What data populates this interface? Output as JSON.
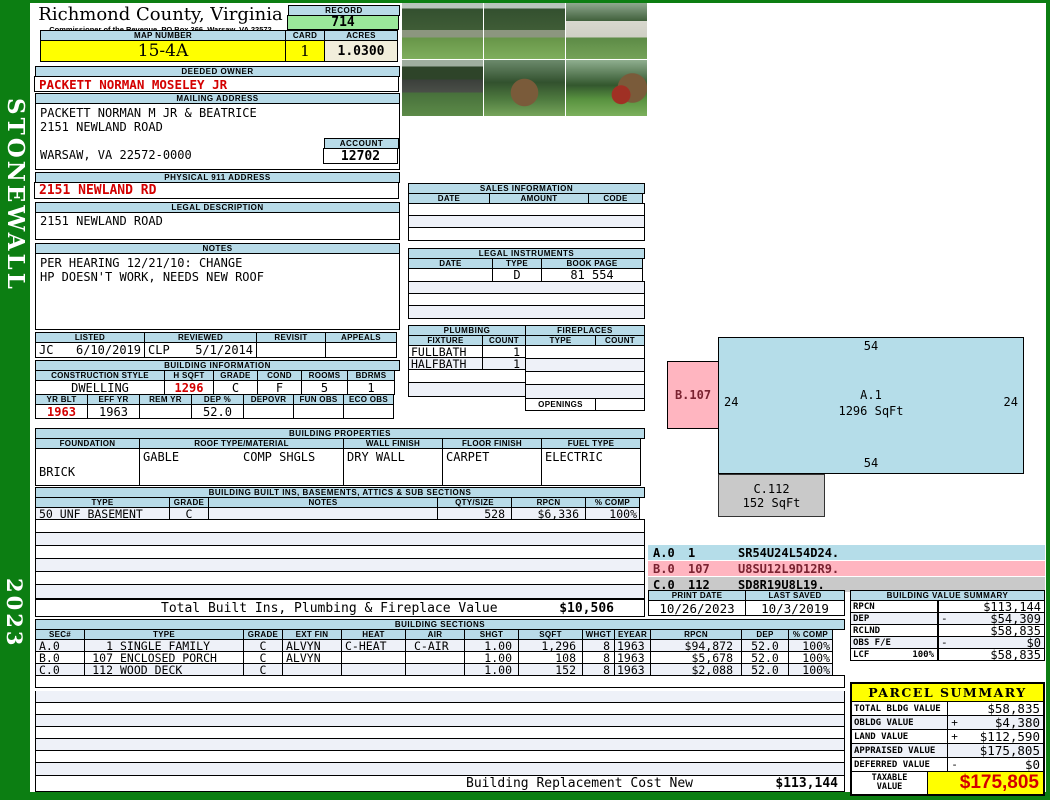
{
  "colors": {
    "frame_green": "#0c7e12",
    "header_blue": "#b8dbe8",
    "highlight_yellow": "#ffff00",
    "record_green": "#9ae89a",
    "acres_cream": "#f1eedb",
    "row_alt": "#eef1f8",
    "sketch_blue": "#b5dde9",
    "sketch_pink": "#ffb5c0",
    "sketch_gray": "#c9c9c9",
    "value_red": "#d40000"
  },
  "sidebar": {
    "district": "STONEWALL",
    "year": "2023"
  },
  "header": {
    "county": "Richmond County, Virginia",
    "commissioner": "Commissioner of the Revenue, PO Box 366, Warsaw, VA 22572",
    "record_label": "RECORD",
    "record_value": "714",
    "map_number_label": "MAP NUMBER",
    "map_number": "15-4A",
    "card_label": "CARD",
    "card": "1",
    "acres_label": "ACRES",
    "acres": "1.0300"
  },
  "owner": {
    "deeded_owner_label": "DEEDED OWNER",
    "deeded_owner": "PACKETT NORMAN MOSELEY JR",
    "mailing_address_label": "MAILING ADDRESS",
    "mailing_line1": "PACKETT NORMAN M JR & BEATRICE",
    "mailing_line2": "2151 NEWLAND ROAD",
    "mailing_line3": "WARSAW, VA 22572-0000",
    "account_label": "ACCOUNT",
    "account": "12702",
    "physical_address_label": "PHYSICAL 911 ADDRESS",
    "physical_address": "2151 NEWLAND RD",
    "legal_description_label": "LEGAL DESCRIPTION",
    "legal_description": "2151 NEWLAND ROAD"
  },
  "notes": {
    "label": "NOTES",
    "line1": "PER HEARING 12/21/10: CHANGE",
    "line2": "HP DOESN'T WORK, NEEDS NEW ROOF"
  },
  "visits": {
    "listed_label": "LISTED",
    "listed_by": "JC",
    "listed_date": "6/10/2019",
    "reviewed_label": "REVIEWED",
    "reviewed_by": "CLP",
    "reviewed_date": "5/1/2014",
    "revisit_label": "REVISIT",
    "appeals_label": "APPEALS"
  },
  "building_info": {
    "section_label": "BUILDING INFORMATION",
    "construction_style_label": "CONSTRUCTION STYLE",
    "construction_style": "DWELLING",
    "hsqft_label": "H SQFT",
    "hsqft": "1296",
    "grade_label": "GRADE",
    "grade": "C",
    "cond_label": "COND",
    "cond": "F",
    "rooms_label": "ROOMS",
    "rooms": "5",
    "bdrms_label": "BDRMS",
    "bdrms": "1",
    "yrblt_label": "YR BLT",
    "yrblt": "1963",
    "effyr_label": "EFF YR",
    "effyr": "1963",
    "remyr_label": "REM YR",
    "remyr": "",
    "dep_label": "DEP %",
    "dep": "52.0",
    "depovr_label": "DEPOVR",
    "depovr": "",
    "funobs_label": "FUN OBS",
    "funobs": "",
    "ecoobs_label": "ECO OBS",
    "ecoobs": ""
  },
  "building_properties": {
    "section_label": "BUILDING PROPERTIES",
    "foundation_label": "FOUNDATION",
    "foundation": "BRICK",
    "roof_label": "ROOF TYPE/MATERIAL",
    "roof_type": "GABLE",
    "roof_material": "COMP SHGLS",
    "wall_label": "WALL FINISH",
    "wall": "DRY WALL",
    "floor_label": "FLOOR FINISH",
    "floor": "CARPET",
    "fuel_label": "FUEL TYPE",
    "fuel": "ELECTRIC"
  },
  "built_ins": {
    "section_label": "BUILDING BUILT INS, BASEMENTS, ATTICS & SUB SECTIONS",
    "type_label": "TYPE",
    "grade_label": "GRADE",
    "notes_label": "NOTES",
    "qty_label": "QTY/SIZE",
    "rpcn_label": "RPCN",
    "comp_label": "% COMP",
    "row": {
      "type": "50 UNF BASEMENT",
      "grade": "C",
      "notes": "",
      "qty": "528",
      "rpcn": "$6,336",
      "comp": "100%"
    },
    "total_label": "Total Built Ins, Plumbing & Fireplace Value",
    "total_value": "$10,506"
  },
  "sales": {
    "section_label": "SALES INFORMATION",
    "date_label": "DATE",
    "amount_label": "AMOUNT",
    "code_label": "CODE"
  },
  "legal_instruments": {
    "section_label": "LEGAL INSTRUMENTS",
    "date_label": "DATE",
    "type_label": "TYPE",
    "book_label": "BOOK PAGE",
    "row": {
      "date": "",
      "type": "D",
      "book_page": "81 554"
    }
  },
  "plumbing": {
    "section_label": "PLUMBING",
    "fixture_label": "FIXTURE",
    "count_label": "COUNT",
    "rows": [
      {
        "fixture": "FULLBATH",
        "count": "1"
      },
      {
        "fixture": "HALFBATH",
        "count": "1"
      }
    ]
  },
  "fireplaces": {
    "section_label": "FIREPLACES",
    "type_label": "TYPE",
    "count_label": "COUNT",
    "openings_label": "OPENINGS"
  },
  "sketch": {
    "main_label": "A.1",
    "main_sqft": "1296 SqFt",
    "dim_top": "54",
    "dim_left": "24",
    "dim_right": "24",
    "dim_bottom": "54",
    "porch_label": "B.107",
    "deck_label": "C.112",
    "deck_sqft": "152 SqFt",
    "legend": [
      {
        "sec": "A.0",
        "code": "1",
        "vector": "SR54U24L54D24."
      },
      {
        "sec": "B.0",
        "code": "107",
        "vector": "U8SU12L9D12R9."
      },
      {
        "sec": "C.0",
        "code": "112",
        "vector": "SD8R19U8L19."
      }
    ]
  },
  "dates": {
    "print_label": "PRINT DATE",
    "print_date": "10/26/2023",
    "saved_label": "LAST SAVED",
    "saved_date": "10/3/2019"
  },
  "value_summary": {
    "section_label": "BUILDING VALUE SUMMARY",
    "rows": [
      {
        "label": "RPCN",
        "pct": "",
        "op": "",
        "value": "$113,144"
      },
      {
        "label": "DEP",
        "pct": "",
        "op": "-",
        "value": "$54,309"
      },
      {
        "label": "RCLND",
        "pct": "",
        "op": "",
        "value": "$58,835"
      },
      {
        "label": "OBS F/E",
        "pct": "",
        "op": "-",
        "value": "$0"
      },
      {
        "label": "LCF",
        "pct": "100%",
        "op": "",
        "value": "$58,835"
      }
    ]
  },
  "building_sections": {
    "section_label": "BUILDING SECTIONS",
    "headers": {
      "sec": "SEC#",
      "type": "TYPE",
      "grade": "GRADE",
      "ext": "EXT FIN",
      "heat": "HEAT",
      "air": "AIR",
      "shgt": "SHGT",
      "sqft": "SQFT",
      "whgt": "WHGT",
      "eyear": "EYEAR",
      "rpcn": "RPCN",
      "dep": "DEP",
      "comp": "% COMP"
    },
    "rows": [
      {
        "sec": "A.0",
        "code": "1",
        "name": "SINGLE FAMILY",
        "grade": "C",
        "ext": "ALVYN",
        "heat": "C-HEAT",
        "air": "C-AIR",
        "shgt": "1.00",
        "sqft": "1,296",
        "whgt": "8",
        "eyear": "1963",
        "rpcn": "$94,872",
        "dep": "52.0",
        "comp": "100%"
      },
      {
        "sec": "B.0",
        "code": "107",
        "name": "ENCLOSED PORCH",
        "grade": "C",
        "ext": "ALVYN",
        "heat": "",
        "air": "",
        "shgt": "1.00",
        "sqft": "108",
        "whgt": "8",
        "eyear": "1963",
        "rpcn": "$5,678",
        "dep": "52.0",
        "comp": "100%"
      },
      {
        "sec": "C.0",
        "code": "112",
        "name": "WOOD DECK",
        "grade": "C",
        "ext": "",
        "heat": "",
        "air": "",
        "shgt": "1.00",
        "sqft": "152",
        "whgt": "8",
        "eyear": "1963",
        "rpcn": "$2,088",
        "dep": "52.0",
        "comp": "100%"
      }
    ],
    "replacement_label": "Building Replacement Cost New",
    "replacement_value": "$113,144"
  },
  "parcel_summary": {
    "title": "PARCEL SUMMARY",
    "rows": [
      {
        "label": "TOTAL BLDG VALUE",
        "op": "",
        "value": "$58,835"
      },
      {
        "label": "OBLDG VALUE",
        "op": "+",
        "value": "$4,380"
      },
      {
        "label": "LAND VALUE",
        "op": "+",
        "value": "$112,590"
      },
      {
        "label": "APPRAISED VALUE",
        "op": "",
        "value": "$175,805"
      },
      {
        "label": "DEFERRED VALUE",
        "op": "-",
        "value": "$0"
      }
    ],
    "taxable_label_line1": "TAXABLE",
    "taxable_label_line2": "VALUE",
    "taxable_value": "$175,805"
  }
}
